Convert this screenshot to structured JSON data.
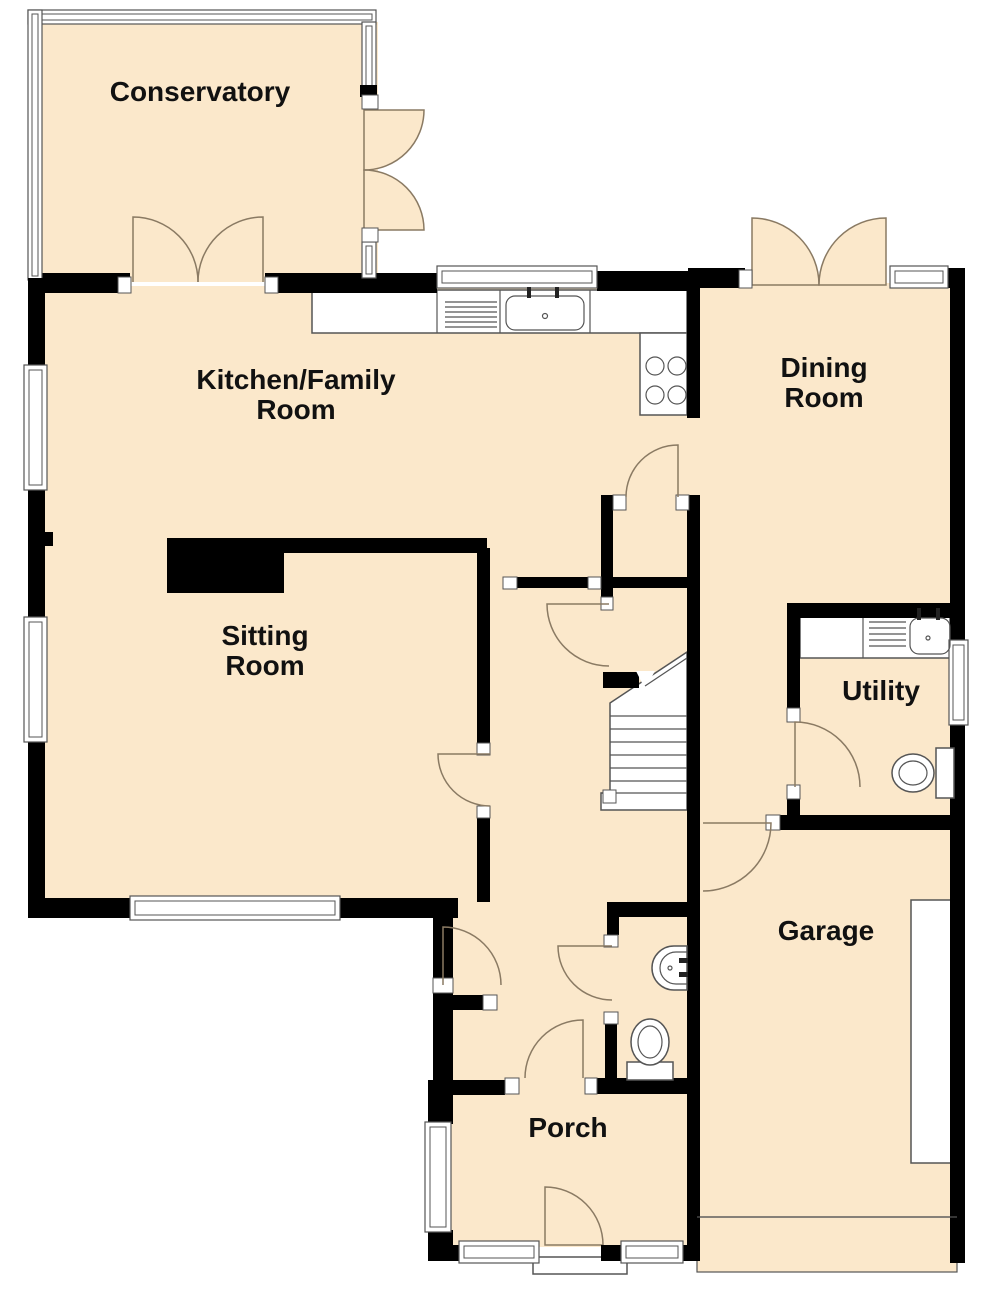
{
  "plan": {
    "type": "floor-plan",
    "rooms": {
      "conservatory": {
        "label": "Conservatory"
      },
      "kitchen_family": {
        "line1": "Kitchen/Family",
        "line2": "Room"
      },
      "dining": {
        "line1": "Dining",
        "line2": "Room"
      },
      "sitting": {
        "line1": "Sitting",
        "line2": "Room"
      },
      "utility": {
        "label": "Utility"
      },
      "garage": {
        "label": "Garage"
      },
      "porch": {
        "label": "Porch"
      }
    },
    "fixtures": {
      "kitchen": [
        "worktop",
        "sink-with-drainer",
        "hob-4-rings"
      ],
      "utility": [
        "worktop",
        "sink-with-drainer",
        "toilet"
      ],
      "wc": [
        "wash-basin",
        "toilet"
      ],
      "hall": [
        "staircase"
      ],
      "garage": [
        "workbench",
        "garage-door"
      ],
      "porch": [
        "entrance-door",
        "threshold-step"
      ]
    },
    "colors": {
      "floor": "#FBE8CB",
      "wall": "#000000",
      "door_arc": "#8A7A63",
      "fixture_outline": "#555555",
      "background": "#FFFFFF"
    }
  }
}
